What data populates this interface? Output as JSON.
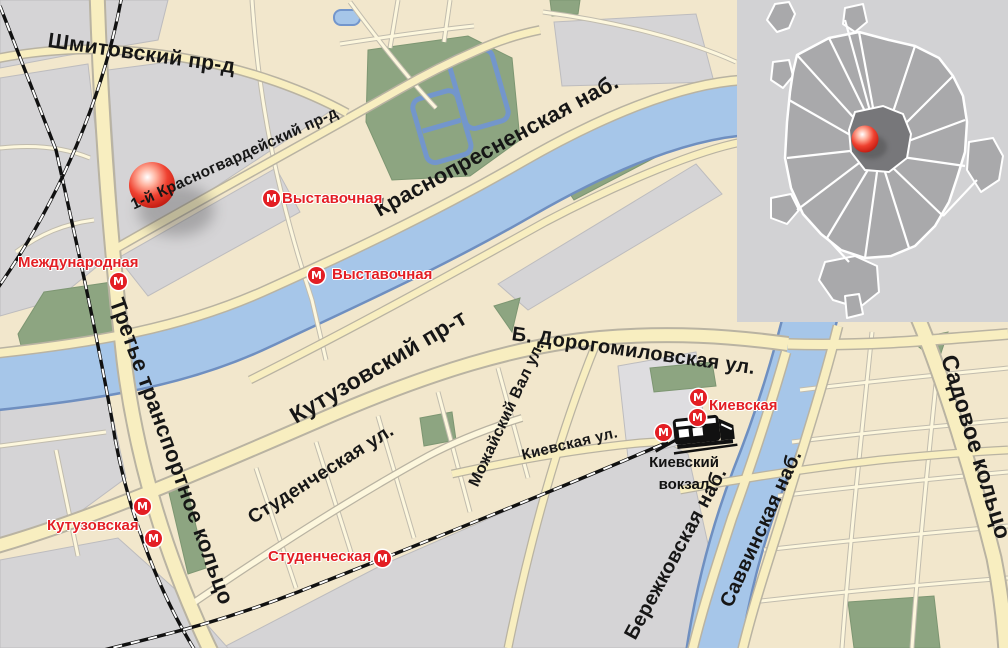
{
  "metro_icon_letter": "М",
  "street_labels": [
    {
      "id": "shmitovsky",
      "text": "Шмитовский пр-д"
    },
    {
      "id": "krasnogvardeysky",
      "text": "1-й Красногвардейский пр-д"
    },
    {
      "id": "krasnopresnenskaya",
      "text": "Краснопресненская наб."
    },
    {
      "id": "kutuzovsky",
      "text": "Кутузовский пр-т"
    },
    {
      "id": "dorogomilovskaya",
      "text": "Б. Дорогомиловская ул."
    },
    {
      "id": "studencheskaya-ul",
      "text": "Студенческая ул."
    },
    {
      "id": "mozhaysky-val",
      "text": "Можайский Вал ул."
    },
    {
      "id": "kievskaya-ul",
      "text": "Киевская ул."
    },
    {
      "id": "ttk",
      "text": "Третье транспортное кольцо"
    },
    {
      "id": "sadovoe",
      "text": "Садовое кольцо"
    },
    {
      "id": "berezhkovskaya",
      "text": "Бережковская наб."
    },
    {
      "id": "savvinskaya",
      "text": "Саввинская наб."
    }
  ],
  "metro_labels": [
    {
      "id": "vystavochnaya-1",
      "text": "Выставочная"
    },
    {
      "id": "vystavochnaya-2",
      "text": "Выставочная"
    },
    {
      "id": "mezhdunarodnaya",
      "text": "Международная"
    },
    {
      "id": "kutuzovskaya",
      "text": "Кутузовская"
    },
    {
      "id": "studencheskaya",
      "text": "Студенческая"
    },
    {
      "id": "kievskaya",
      "text": "Киевская"
    }
  ],
  "railway_station": {
    "line1": "Киевский",
    "line2": "вокзал"
  },
  "colors": {
    "land": "#f2e7cc",
    "block_gray": "#d5d4d6",
    "green": "#8da581",
    "water": "#a6c6e9",
    "water_edge": "#6f8fc0",
    "road_fill": "#f8eec0",
    "road_casing": "#b9b3a2",
    "minor_road_fill": "#fdf7dd",
    "metro_red": "#e31e24",
    "marker_red": "#e03122",
    "inset_bg": "#d2d2d4",
    "inset_city": "#a9a9ab",
    "inset_center": "#77777a"
  }
}
